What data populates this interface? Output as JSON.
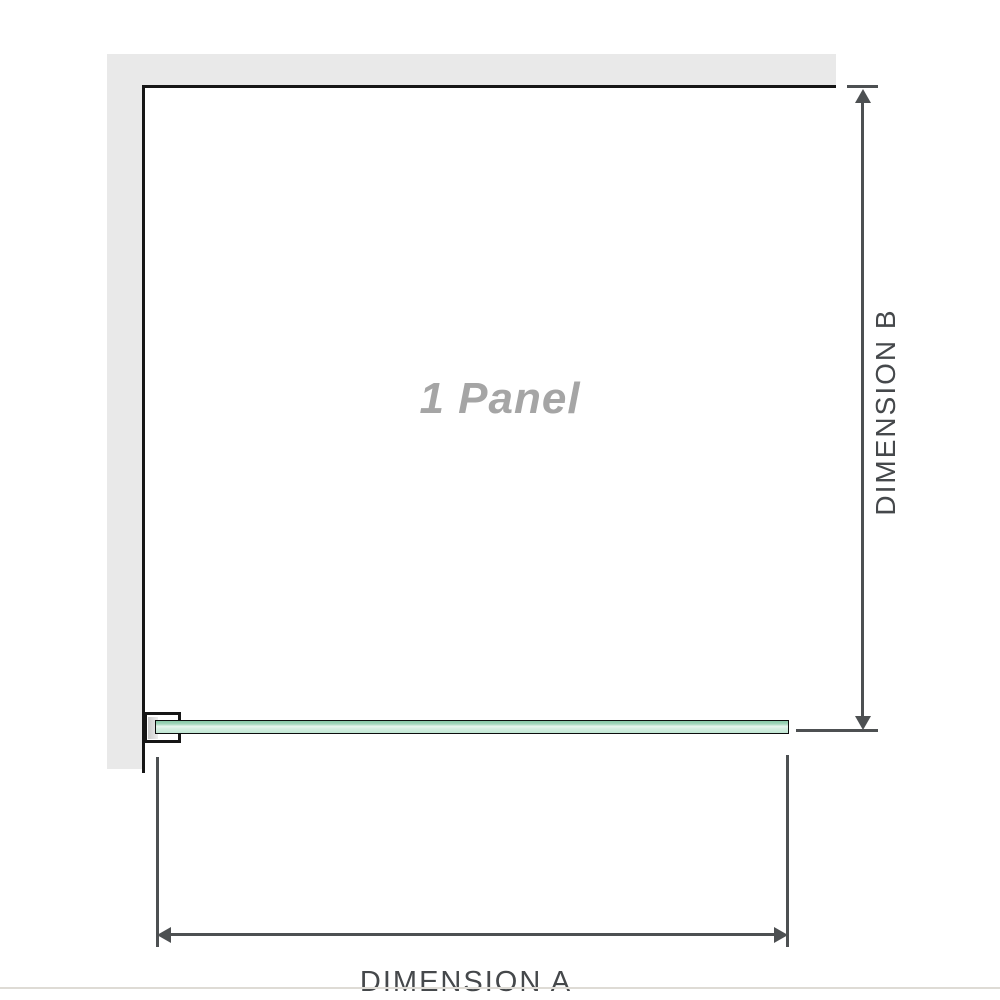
{
  "diagram": {
    "panel_label": "1 Panel",
    "dimensions": {
      "a": {
        "label": "DIMENSION A",
        "orientation": "horizontal"
      },
      "b": {
        "label": "DIMENSION B",
        "orientation": "vertical"
      }
    },
    "elements": {
      "wall": "L-shaped wall (top and left)",
      "glass_panel": "single glass panel shown in green",
      "wall_bracket": "wall mounting bracket holding glass panel"
    }
  },
  "colors": {
    "wall": "#e9e9e9",
    "outline": "#161616",
    "dimension": "#4d5052",
    "label": "#45484b",
    "panel_text": "#a5a5a5",
    "glass_top": "#86c7a6",
    "glass_highlight": "#e9f6ef",
    "glass_bottom": "#bfe6d2",
    "baseline": "#dedbd5"
  }
}
